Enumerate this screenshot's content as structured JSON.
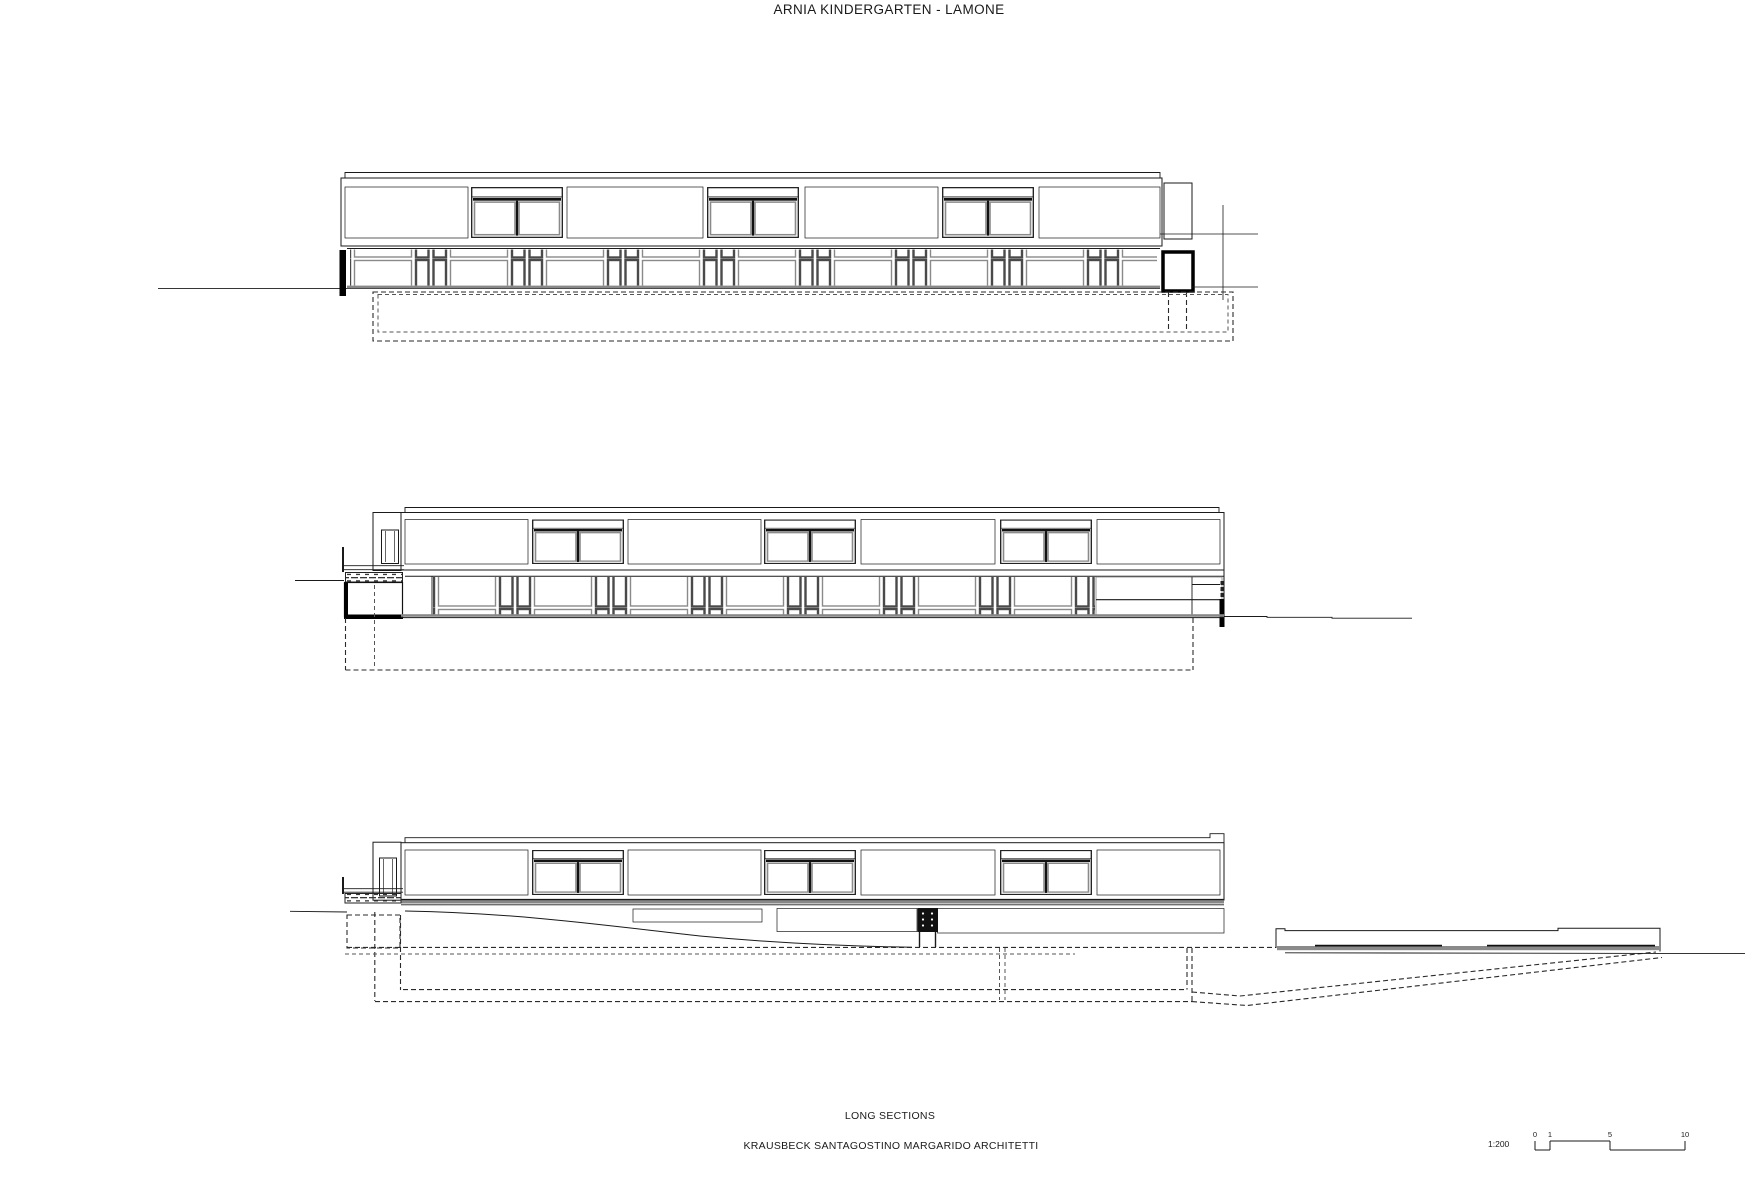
{
  "title": "ARNIA KINDERGARTEN - LAMONE",
  "footer": {
    "drawing_type": "LONG SECTIONS",
    "firm": "KRAUSBECK SANTAGOSTINO MARGARIDO ARCHITETTI"
  },
  "scale_bar": {
    "ratio": "1:200",
    "ticks": [
      "0",
      "1",
      "5",
      "10"
    ]
  },
  "sections": [
    {
      "id": "long-section-1"
    },
    {
      "id": "long-section-2"
    },
    {
      "id": "long-section-3"
    }
  ],
  "colors": {
    "line": "#1a1a1a",
    "frame_gray": "#8a8a8a",
    "slab_gray": "#808080",
    "background": "#ffffff"
  }
}
